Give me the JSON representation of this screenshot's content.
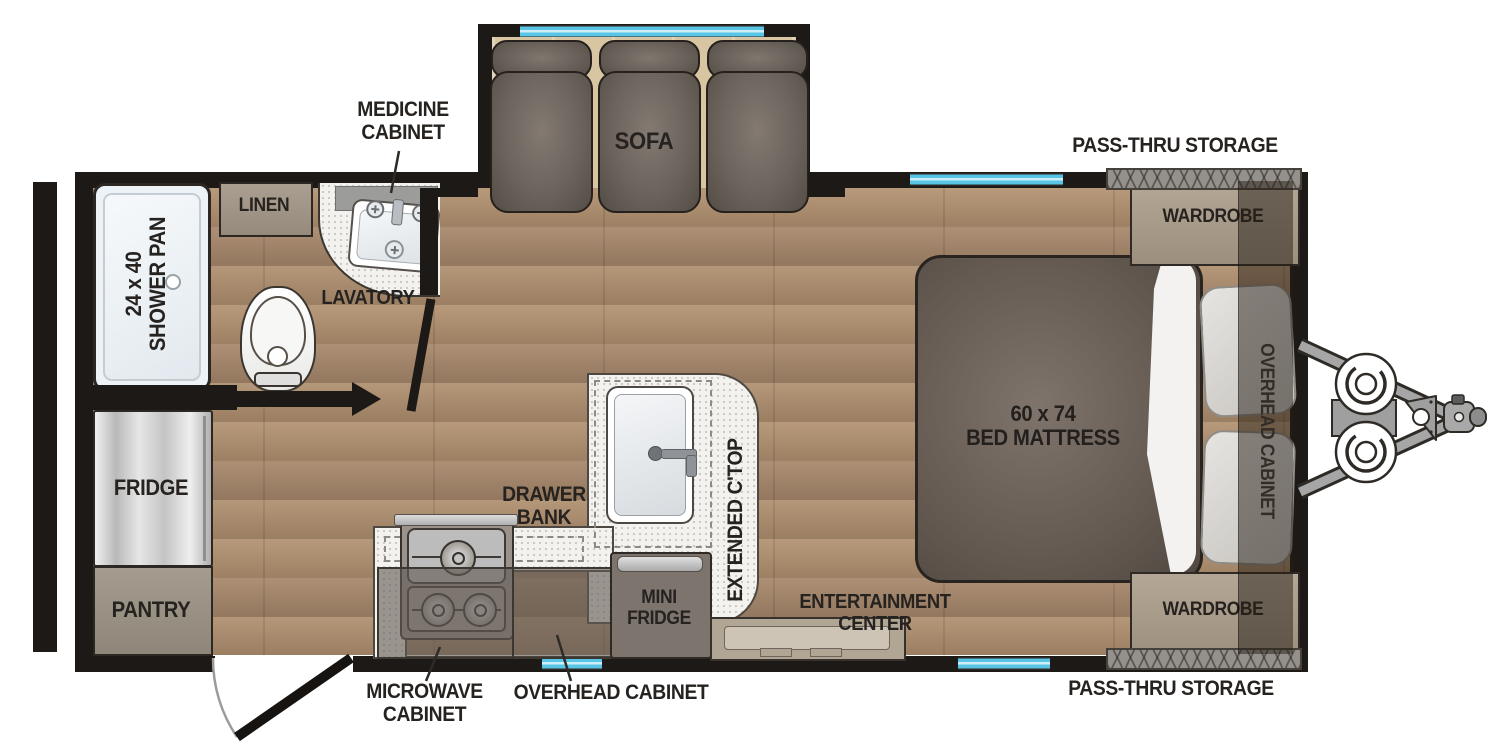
{
  "floorplan": {
    "labels": {
      "pass_thru_top": "PASS-THRU STORAGE",
      "pass_thru_bottom": "PASS-THRU STORAGE",
      "medicine_cabinet": "MEDICINE CABINET",
      "sofa": "SOFA",
      "linen": "LINEN",
      "lavatory": "LAVATORY",
      "shower_size": "24 x 40",
      "shower_name": "SHOWER PAN",
      "fridge": "FRIDGE",
      "pantry": "PANTRY",
      "drawer_bank": "DRAWER BANK",
      "extended_ctop": "EXTENDED C'TOP",
      "mini_fridge": "MINI FRIDGE",
      "microwave_cabinet": "MICROWAVE CABINET",
      "overhead_cabinet_kitchen": "OVERHEAD CABINET",
      "entertainment_center": "ENTERTAINMENT CENTER",
      "bed_size": "60 x 74",
      "bed_name": "BED MATTRESS",
      "wardrobe_front": "WARDROBE",
      "wardrobe_rear": "WARDROBE",
      "overhead_cabinet_bedroom": "OVERHEAD CABINET"
    },
    "colors": {
      "wall": "#1d1916",
      "floor_wood": "#ab8b6c",
      "slideout_floor": "#d8c6a3",
      "window_blue": "#5ac6e6",
      "counter_white": "#f3f2ef",
      "label_text": "#26221f"
    }
  }
}
